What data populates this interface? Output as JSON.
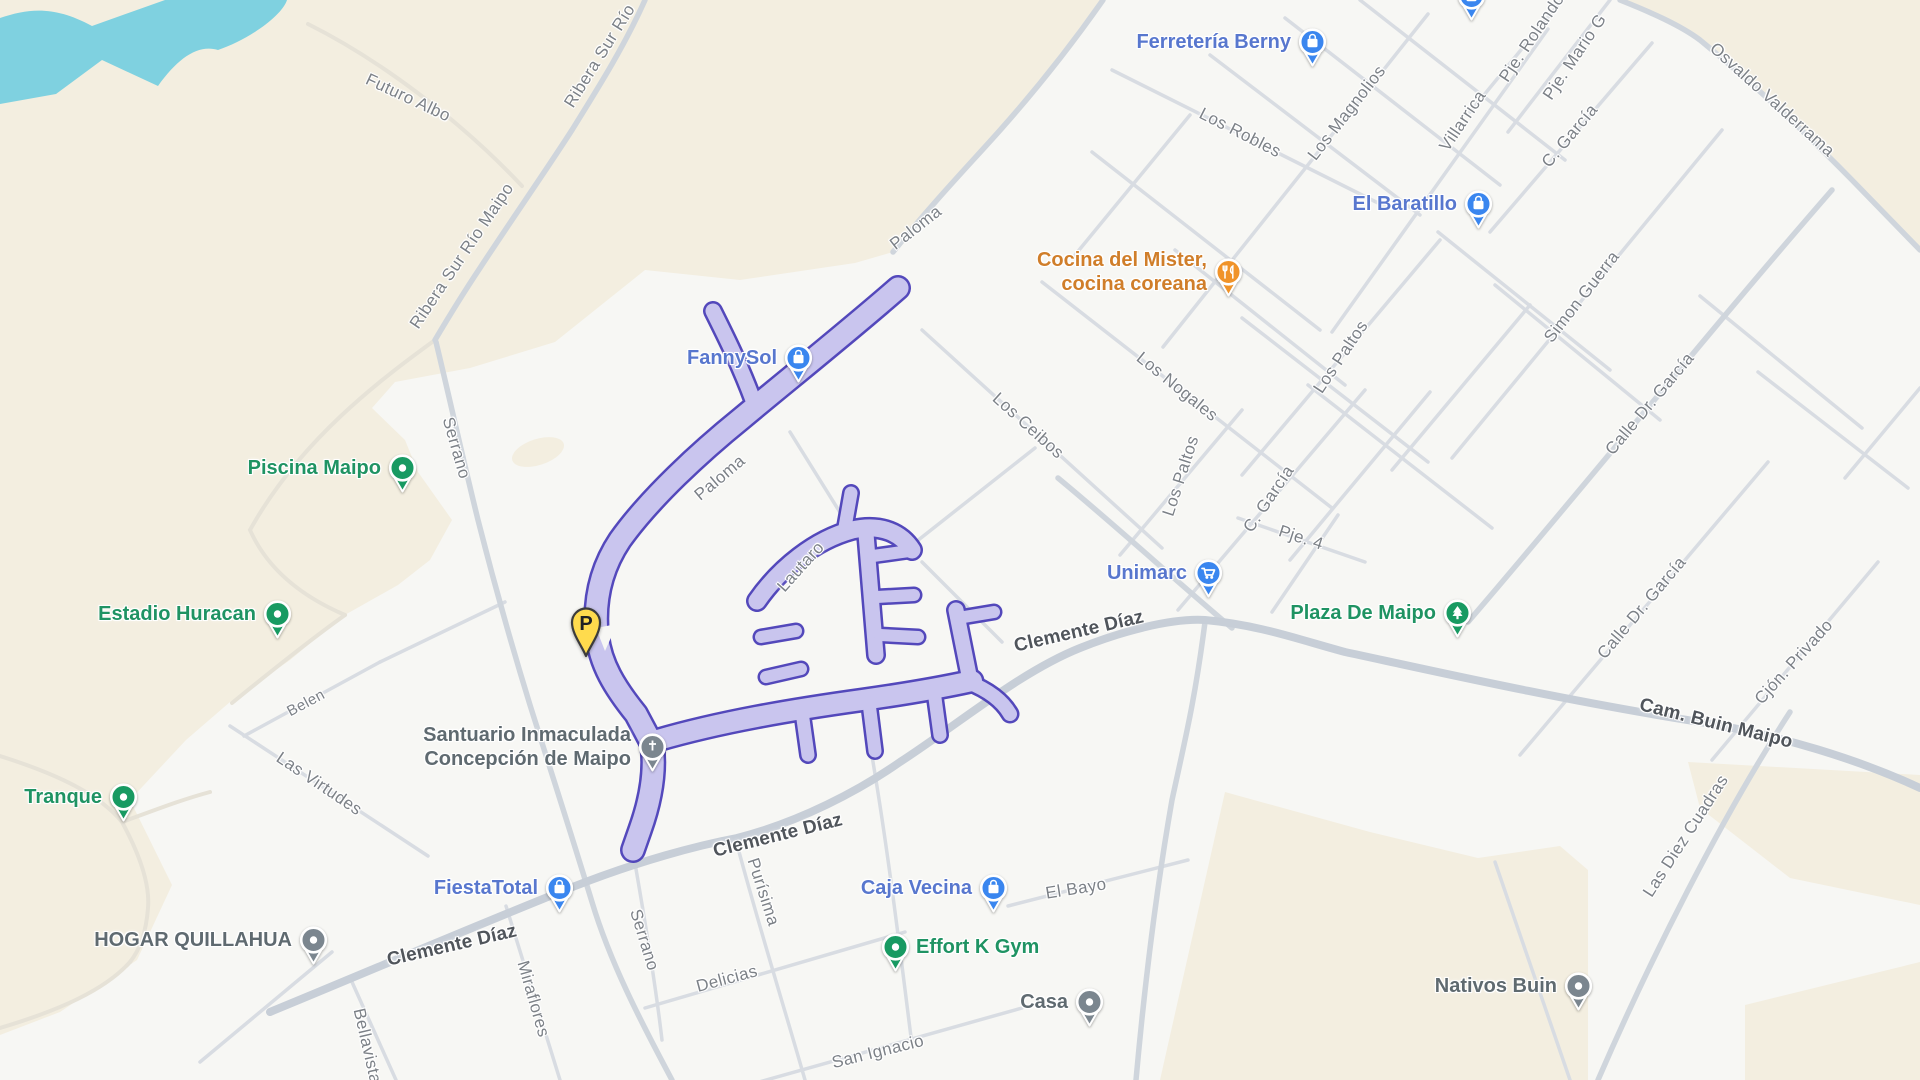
{
  "app": {
    "title": "Map view — Maipo / Buin area"
  },
  "colors": {
    "land-rural": "#F3EEE0",
    "land-urban": "#F7F7F4",
    "water": "#7FD1E0",
    "road-minor": "#D8DCE2",
    "road-mid": "#CFD5DC",
    "road-major": "#C7CED7",
    "road-rural": "#E6E2D7",
    "selection-fill": "#C9C5EE",
    "selection-outline": "#4B3FB8",
    "poi-blue": "#3A86EF",
    "poi-green": "#189A62",
    "poi-orange": "#F09329",
    "poi-gray": "#7B868F",
    "label-blue": "#5877CE",
    "label-green": "#1F9363",
    "label-orange": "#D07E2A",
    "label-gray": "#5F6A70",
    "street-minor": "#7C8187",
    "street-major": "#50555B",
    "parking-fill": "#FFDB4D",
    "parking-outline": "#3C3C3C"
  },
  "parking_marker": {
    "letter": "P",
    "tip_x": 586,
    "tip_y": 656
  },
  "pois": [
    {
      "id": "ferreteria-berny",
      "lines": [
        "Ferretería Berny"
      ],
      "icon": "bag",
      "color": "poi-blue",
      "label_color": "label-blue",
      "x": 1312,
      "y": 42,
      "side": "left"
    },
    {
      "id": "el-baratillo",
      "lines": [
        "El Baratillo"
      ],
      "icon": "bag",
      "color": "poi-blue",
      "label_color": "label-blue",
      "x": 1478,
      "y": 204,
      "side": "left"
    },
    {
      "id": "cocina-del-mister",
      "lines": [
        "Cocina del Mister,",
        "cocina coreana"
      ],
      "icon": "food",
      "color": "poi-orange",
      "label_color": "label-orange",
      "x": 1228,
      "y": 272,
      "side": "left"
    },
    {
      "id": "fannysol",
      "lines": [
        "FannySol"
      ],
      "icon": "bag",
      "color": "poi-blue",
      "label_color": "label-blue",
      "x": 798,
      "y": 358,
      "side": "left"
    },
    {
      "id": "piscina-maipo",
      "lines": [
        "Piscina Maipo"
      ],
      "icon": "dot",
      "color": "poi-green",
      "label_color": "label-green",
      "x": 402,
      "y": 468,
      "side": "left"
    },
    {
      "id": "estadio-huracan",
      "lines": [
        "Estadio Huracan"
      ],
      "icon": "dot",
      "color": "poi-green",
      "label_color": "label-green",
      "x": 277,
      "y": 614,
      "side": "left"
    },
    {
      "id": "tranque",
      "lines": [
        "Tranque"
      ],
      "icon": "dot",
      "color": "poi-green",
      "label_color": "label-green",
      "x": 123,
      "y": 797,
      "side": "left"
    },
    {
      "id": "hogar-quillahua",
      "lines": [
        "HOGAR QUILLAHUA"
      ],
      "icon": "dot",
      "color": "poi-gray",
      "label_color": "label-gray",
      "x": 313,
      "y": 940,
      "side": "left"
    },
    {
      "id": "santuario-inmaculada",
      "lines": [
        "Santuario Inmaculada",
        "Concepción de Maipo"
      ],
      "icon": "church",
      "color": "poi-gray",
      "label_color": "label-gray",
      "x": 652,
      "y": 747,
      "side": "left"
    },
    {
      "id": "fiestatotal",
      "lines": [
        "FiestaTotal"
      ],
      "icon": "bag",
      "color": "poi-blue",
      "label_color": "label-blue",
      "x": 559,
      "y": 888,
      "side": "left"
    },
    {
      "id": "caja-vecina",
      "lines": [
        "Caja Vecina"
      ],
      "icon": "bag",
      "color": "poi-blue",
      "label_color": "label-blue",
      "x": 993,
      "y": 888,
      "side": "left"
    },
    {
      "id": "effort-k-gym",
      "lines": [
        "Effort K Gym"
      ],
      "icon": "dot",
      "color": "poi-green",
      "label_color": "label-green",
      "x": 895,
      "y": 947,
      "side": "right"
    },
    {
      "id": "casa",
      "lines": [
        "Casa"
      ],
      "icon": "dot",
      "color": "poi-gray",
      "label_color": "label-gray",
      "x": 1089,
      "y": 1002,
      "side": "left"
    },
    {
      "id": "unimarc",
      "lines": [
        "Unimarc"
      ],
      "icon": "cart",
      "color": "poi-blue",
      "label_color": "label-blue",
      "x": 1208,
      "y": 573,
      "side": "left"
    },
    {
      "id": "plaza-de-maipo",
      "lines": [
        "Plaza De Maipo"
      ],
      "icon": "tree",
      "color": "poi-green",
      "label_color": "label-green",
      "x": 1457,
      "y": 613,
      "side": "left"
    },
    {
      "id": "nativos-buin",
      "lines": [
        "Nativos Buin"
      ],
      "icon": "dot",
      "color": "poi-gray",
      "label_color": "label-gray",
      "x": 1578,
      "y": 986,
      "side": "left"
    },
    {
      "id": "storefront-partial-top",
      "lines": [],
      "icon": "bag",
      "color": "poi-blue",
      "label_color": "label-blue",
      "x": 1471,
      "y": -4,
      "side": "left"
    }
  ],
  "street_labels": [
    {
      "text": "Futuro Albo",
      "x": 408,
      "y": 98,
      "deg": 25,
      "cls": "minor"
    },
    {
      "text": "Ribera Sur Río",
      "x": 600,
      "y": 56,
      "deg": -58,
      "cls": "minor"
    },
    {
      "text": "Ribera Sur Río Maipo",
      "x": 462,
      "y": 256,
      "deg": -56,
      "cls": "minor"
    },
    {
      "text": "Serrano",
      "x": 456,
      "y": 448,
      "deg": 74,
      "cls": "minor"
    },
    {
      "text": "Paloma",
      "x": 916,
      "y": 228,
      "deg": -38,
      "cls": "minor"
    },
    {
      "text": "Paloma",
      "x": 720,
      "y": 478,
      "deg": -40,
      "cls": "minor"
    },
    {
      "text": "Los Ceibos",
      "x": 1028,
      "y": 426,
      "deg": 42,
      "cls": "minor"
    },
    {
      "text": "Los Robles",
      "x": 1240,
      "y": 133,
      "deg": 27,
      "cls": "minor"
    },
    {
      "text": "Los Nogales",
      "x": 1177,
      "y": 387,
      "deg": 39,
      "cls": "minor"
    },
    {
      "text": "Los Magnolios",
      "x": 1347,
      "y": 113,
      "deg": -52,
      "cls": "minor"
    },
    {
      "text": "Villarrica",
      "x": 1463,
      "y": 121,
      "deg": -56,
      "cls": "minor"
    },
    {
      "text": "Pje. Rolando",
      "x": 1532,
      "y": 38,
      "deg": -56,
      "cls": "minor"
    },
    {
      "text": "Pje. Mario G",
      "x": 1575,
      "y": 57,
      "deg": -56,
      "cls": "minor"
    },
    {
      "text": "C. García",
      "x": 1570,
      "y": 136,
      "deg": -50,
      "cls": "minor"
    },
    {
      "text": "Osvaldo Valderrama",
      "x": 1772,
      "y": 100,
      "deg": 42,
      "cls": "minor"
    },
    {
      "text": "Simon Guerra",
      "x": 1582,
      "y": 297,
      "deg": -52,
      "cls": "minor"
    },
    {
      "text": "Los Paltos",
      "x": 1341,
      "y": 357,
      "deg": -56,
      "cls": "minor"
    },
    {
      "text": "Los Paltos",
      "x": 1181,
      "y": 476,
      "deg": -72,
      "cls": "minor"
    },
    {
      "text": "C. García",
      "x": 1269,
      "y": 499,
      "deg": -56,
      "cls": "minor"
    },
    {
      "text": "Pje. 4",
      "x": 1301,
      "y": 538,
      "deg": 18,
      "cls": "minor"
    },
    {
      "text": "Calle Dr. García",
      "x": 1650,
      "y": 404,
      "deg": -50,
      "cls": "minor"
    },
    {
      "text": "Calle Dr. García",
      "x": 1642,
      "y": 608,
      "deg": -50,
      "cls": "minor"
    },
    {
      "text": "Cjón. Privado",
      "x": 1794,
      "y": 662,
      "deg": -48,
      "cls": "minor"
    },
    {
      "text": "Cam. Buin Maipo",
      "x": 1716,
      "y": 724,
      "deg": 14,
      "cls": "major"
    },
    {
      "text": "Las Diez Cuadras",
      "x": 1686,
      "y": 836,
      "deg": -57,
      "cls": "minor"
    },
    {
      "text": "Clemente Díaz",
      "x": 1079,
      "y": 632,
      "deg": -13,
      "cls": "major"
    },
    {
      "text": "Clemente Díaz",
      "x": 452,
      "y": 946,
      "deg": -13,
      "cls": "major"
    },
    {
      "text": "Clemente Díaz",
      "x": 778,
      "y": 836,
      "deg": -14,
      "cls": "major"
    },
    {
      "text": "Miraflores",
      "x": 533,
      "y": 999,
      "deg": 74,
      "cls": "minor"
    },
    {
      "text": "Bellavista",
      "x": 367,
      "y": 1046,
      "deg": 77,
      "cls": "minor"
    },
    {
      "text": "Serrano",
      "x": 644,
      "y": 940,
      "deg": 73,
      "cls": "minor"
    },
    {
      "text": "Delicias",
      "x": 727,
      "y": 979,
      "deg": -15,
      "cls": "minor"
    },
    {
      "text": "Purísima",
      "x": 763,
      "y": 892,
      "deg": 72,
      "cls": "minor"
    },
    {
      "text": "San Ignacio",
      "x": 878,
      "y": 1052,
      "deg": -14,
      "cls": "minor"
    },
    {
      "text": "El Bayo",
      "x": 1076,
      "y": 889,
      "deg": -9,
      "cls": "minor"
    },
    {
      "text": "Las Virtudes",
      "x": 319,
      "y": 784,
      "deg": 34,
      "cls": "minor"
    },
    {
      "text": "Belen",
      "x": 306,
      "y": 703,
      "deg": -28,
      "cls": "small"
    },
    {
      "text": "Lautaro",
      "x": 801,
      "y": 567,
      "deg": -48,
      "cls": "minor"
    }
  ]
}
